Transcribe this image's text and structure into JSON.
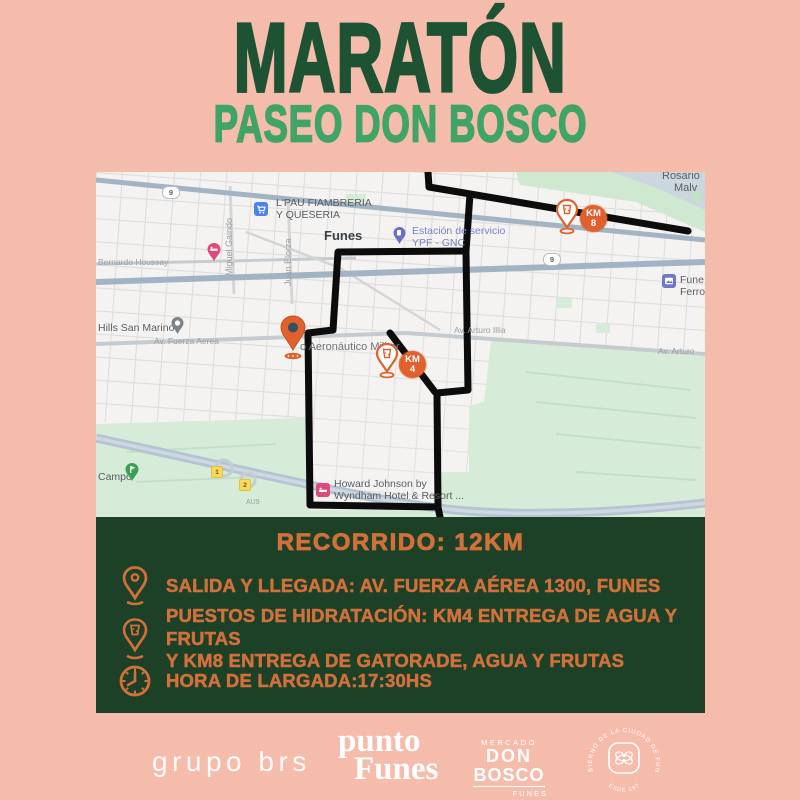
{
  "title": "MARATÓN",
  "subtitle": "PASEO DON BOSCO",
  "map": {
    "town_label": "Funes",
    "poi": {
      "lpau": [
        "L'PAU FIAMBRERIA",
        "Y QUESERIA"
      ],
      "ypf": [
        "Estación de servicio",
        "YPF - GNC"
      ],
      "hills": "Hills San Marino",
      "aeronautico": "o Aeronáutico Militar",
      "howard": [
        "Howard Johnson by",
        "Wyndham Hotel & Resort ..."
      ],
      "campo": "Campo",
      "ferro": [
        "Fune",
        "Ferro"
      ],
      "rosario": [
        "Rosario",
        "Malv"
      ]
    },
    "streets": {
      "bernardo": "Bernardo Houssay",
      "miguel": "Miguel Gaindo",
      "elorza": "Juan Elorza",
      "fuerza": "Av. Fuerza Aerea",
      "arturo": "Av. Arturo Illia",
      "arturo2": "Av. Arturo",
      "au": "AU9"
    },
    "shields": {
      "route9": "9",
      "s1": "1",
      "s2": "2"
    },
    "markers": {
      "km4": [
        "KM",
        "4"
      ],
      "km8": [
        "KM",
        "8"
      ]
    }
  },
  "panel": {
    "heading": "RECORRIDO: 12KM",
    "items": [
      {
        "icon": "location-pin",
        "lines": [
          "SALIDA Y LLEGADA: AV. FUERZA AÉREA 1300, FUNES"
        ]
      },
      {
        "icon": "hydration-pin",
        "lines": [
          "PUESTOS DE HIDRATACIÓN: KM4 ENTREGA DE AGUA Y FRUTAS",
          "Y KM8 ENTREGA DE GATORADE, AGUA Y FRUTAS"
        ]
      },
      {
        "icon": "clock",
        "lines": [
          "HORA DE LARGADA:17:30HS"
        ]
      }
    ]
  },
  "footer": {
    "logos": {
      "grupo": "grupo brs",
      "punto": [
        "punto",
        "Funes"
      ],
      "donbosco": [
        "MERCADO",
        "DON",
        "BOSCO",
        "FUNES"
      ],
      "badge": {
        "top": "GOBIERNO DE LA CIUDAD DE FUNES",
        "bottom": "DESDE 1875"
      }
    }
  },
  "colors": {
    "background": "#f5bbab",
    "title_green": "#1d5233",
    "subtitle_green": "#3fa466",
    "panel_green": "#1c4126",
    "accent_orange": "#d2703c",
    "marker_orange": "#e0612d",
    "route_black": "#0c0c0c"
  }
}
